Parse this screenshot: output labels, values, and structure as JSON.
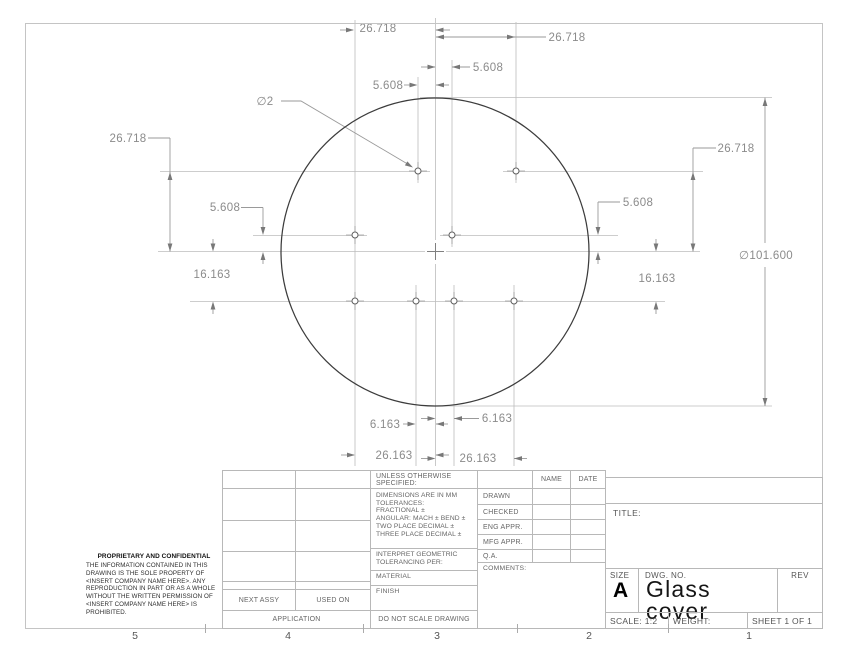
{
  "dims": [
    "26.718",
    "26.718",
    "5.608",
    "5.608",
    "∅2",
    "26.718",
    "5.608",
    "16.163",
    "26.718",
    "5.608",
    "16.163",
    "∅101.600",
    "6.163",
    "6.163",
    "26.163",
    "26.163"
  ],
  "zones": [
    "5",
    "4",
    "3",
    "2",
    "1"
  ],
  "title_block": {
    "unless": "UNLESS OTHERWISE SPECIFIED:",
    "tol": [
      "DIMENSIONS ARE IN MM",
      "TOLERANCES:",
      "FRACTIONAL ±",
      "ANGULAR: MACH ±   BEND ±",
      "TWO PLACE DECIMAL    ±",
      "THREE PLACE DECIMAL  ±"
    ],
    "interpret": [
      "INTERPRET GEOMETRIC",
      "TOLERANCING PER:"
    ],
    "material": "MATERIAL",
    "finish": "FINISH",
    "do_not_scale": "DO NOT SCALE DRAWING",
    "next_assy": "NEXT ASSY",
    "used_on": "USED ON",
    "application": "APPLICATION",
    "name_header": "NAME",
    "date_header": "DATE",
    "approvals": [
      "DRAWN",
      "CHECKED",
      "ENG APPR.",
      "MFG APPR.",
      "Q.A."
    ],
    "comments": "COMMENTS:",
    "title_label": "TITLE:",
    "size_label": "SIZE",
    "size_value": "A",
    "dwg_label": "DWG. NO.",
    "dwg_value": "Glass cover",
    "rev_label": "REV",
    "scale": "SCALE: 1:2",
    "weight": "WEIGHT:",
    "sheet": "SHEET 1 OF 1"
  },
  "proprietary": {
    "heading": "PROPRIETARY AND CONFIDENTIAL",
    "body": "THE INFORMATION CONTAINED IN THIS DRAWING IS THE SOLE PROPERTY OF <INSERT COMPANY NAME HERE>.  ANY REPRODUCTION IN PART OR AS A WHOLE WITHOUT THE WRITTEN PERMISSION OF <INSERT COMPANY NAME HERE> IS PROHIBITED."
  }
}
